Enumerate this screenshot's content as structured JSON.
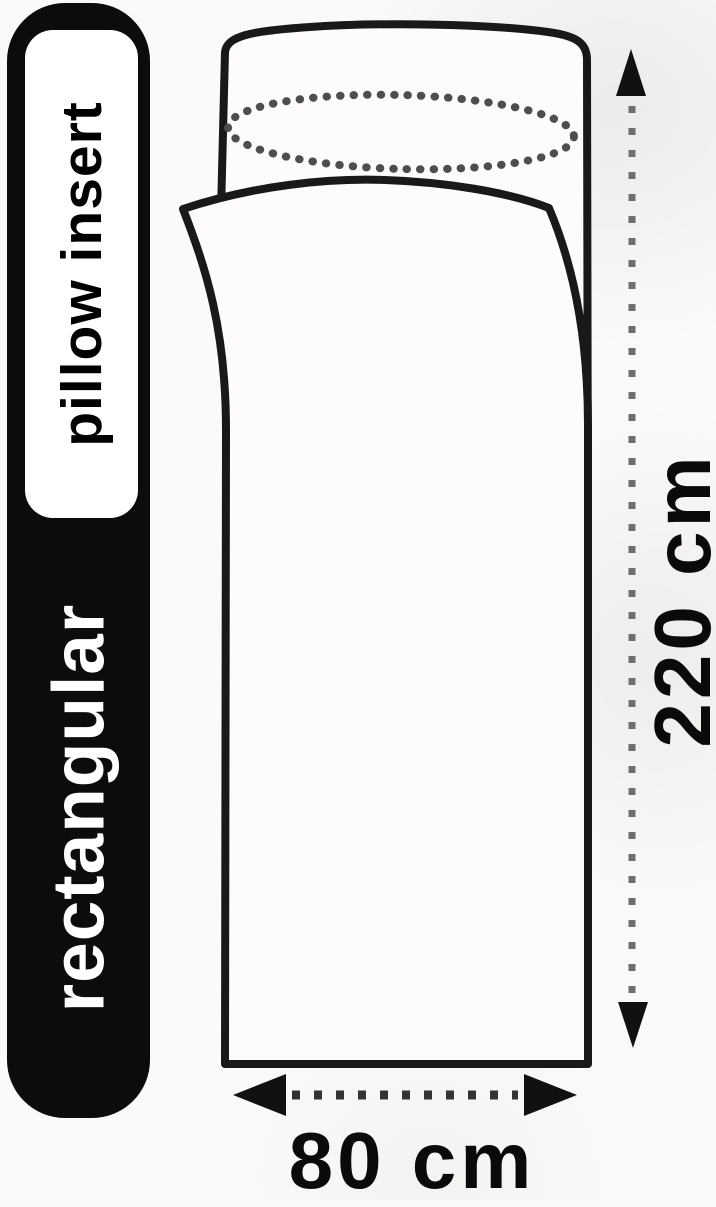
{
  "banner": {
    "category_label": "rectangular",
    "product_label": "pillow insert"
  },
  "dimensions": {
    "height_label": "220 cm",
    "width_label": "80 cm"
  },
  "colors": {
    "background": "#fbfaf9",
    "banner_bg": "#0c0c0c",
    "banner_text": "#ffffff",
    "badge_bg": "#ffffff",
    "badge_text": "#000000",
    "sheet": "#fdfcfb",
    "outline": "#191919",
    "dotted_ellipse": "#4e4e4e",
    "height_arrow_dots": "#6e6e6e",
    "width_arrow_dots": "#333333",
    "arrowhead": "#111111",
    "dimension_text": "#0a0a0a"
  }
}
